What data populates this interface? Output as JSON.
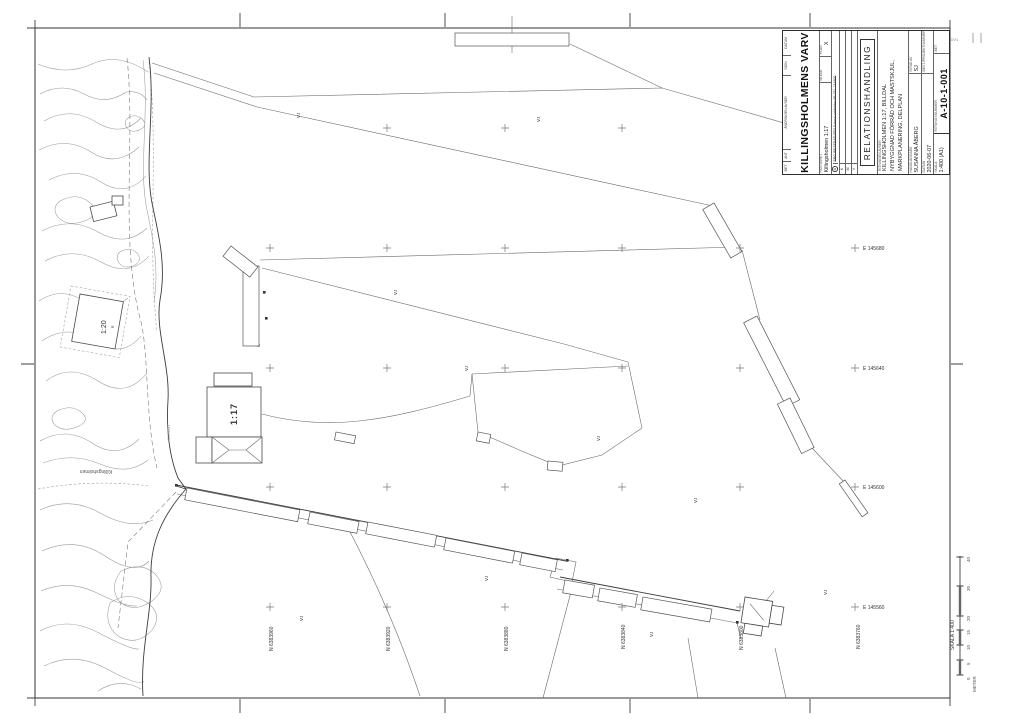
{
  "stamp": "LKS KIDV1",
  "title_block": {
    "revision_columns": [
      "BET",
      "ANT",
      "ÄNDRINGEN AVSER",
      "SIGN",
      "DATUM"
    ],
    "company": "KILLINGSHOLMENS VARV",
    "property_label": "FASTIGHET",
    "property": "Killingsholmen 1:17",
    "stage_label": "SKEDE",
    "stage": "",
    "plan_label": "PLAN",
    "plan": "X",
    "rev_a_letter": "A",
    "rev_a_text": "PROJEKTERAD FFU Kanozi arkitekter AB 031-744800",
    "discipline_rows": [
      "K",
      "M",
      "V"
    ],
    "status": "RELATIONSHANDLING",
    "content_label": "RITNINGEN AVSER",
    "title_lines": [
      "KILLINGSHOLMEN 1:17, BILLDAL",
      "NYBYGGNAD FÖRRÅD OCH MASTSKJUL,",
      "MARKPLANERING, DELPLAN"
    ],
    "handler_label": "HANDLÄGGARE",
    "handler": "SUSANNA ÅBERG",
    "drawn_label": "RITAD AV",
    "drawn": "SJ",
    "date_label": "DATUM",
    "date": "2020-06-07",
    "projnr_label": "BEST./PROJEKTNUMMER",
    "projnr": "",
    "scale_label": "SKALA",
    "scale": "1:400 (A1)",
    "number_label": "RITNINGSNUMMER",
    "number": "A-10-1-001",
    "bet_label": "BET",
    "bet": ""
  },
  "map": {
    "grid_e": [
      "E 145680",
      "E 145640",
      "E 145600",
      "E 145560"
    ],
    "grid_n": [
      "N 6383960",
      "N 6383920",
      "N 6383880",
      "N 6383840",
      "N 6383800",
      "N 6383760"
    ],
    "parcel_1": "1:17",
    "parcel_2": "1:20",
    "water_label": "Killingsholmen",
    "note": "ML 0517",
    "contour_label": "6",
    "vj": "VJ"
  },
  "scale_bar": {
    "title": "SKALA 1:400",
    "unit": "METER",
    "ticks": [
      "0",
      "5",
      "10",
      "15",
      "20",
      "30",
      "40"
    ]
  }
}
